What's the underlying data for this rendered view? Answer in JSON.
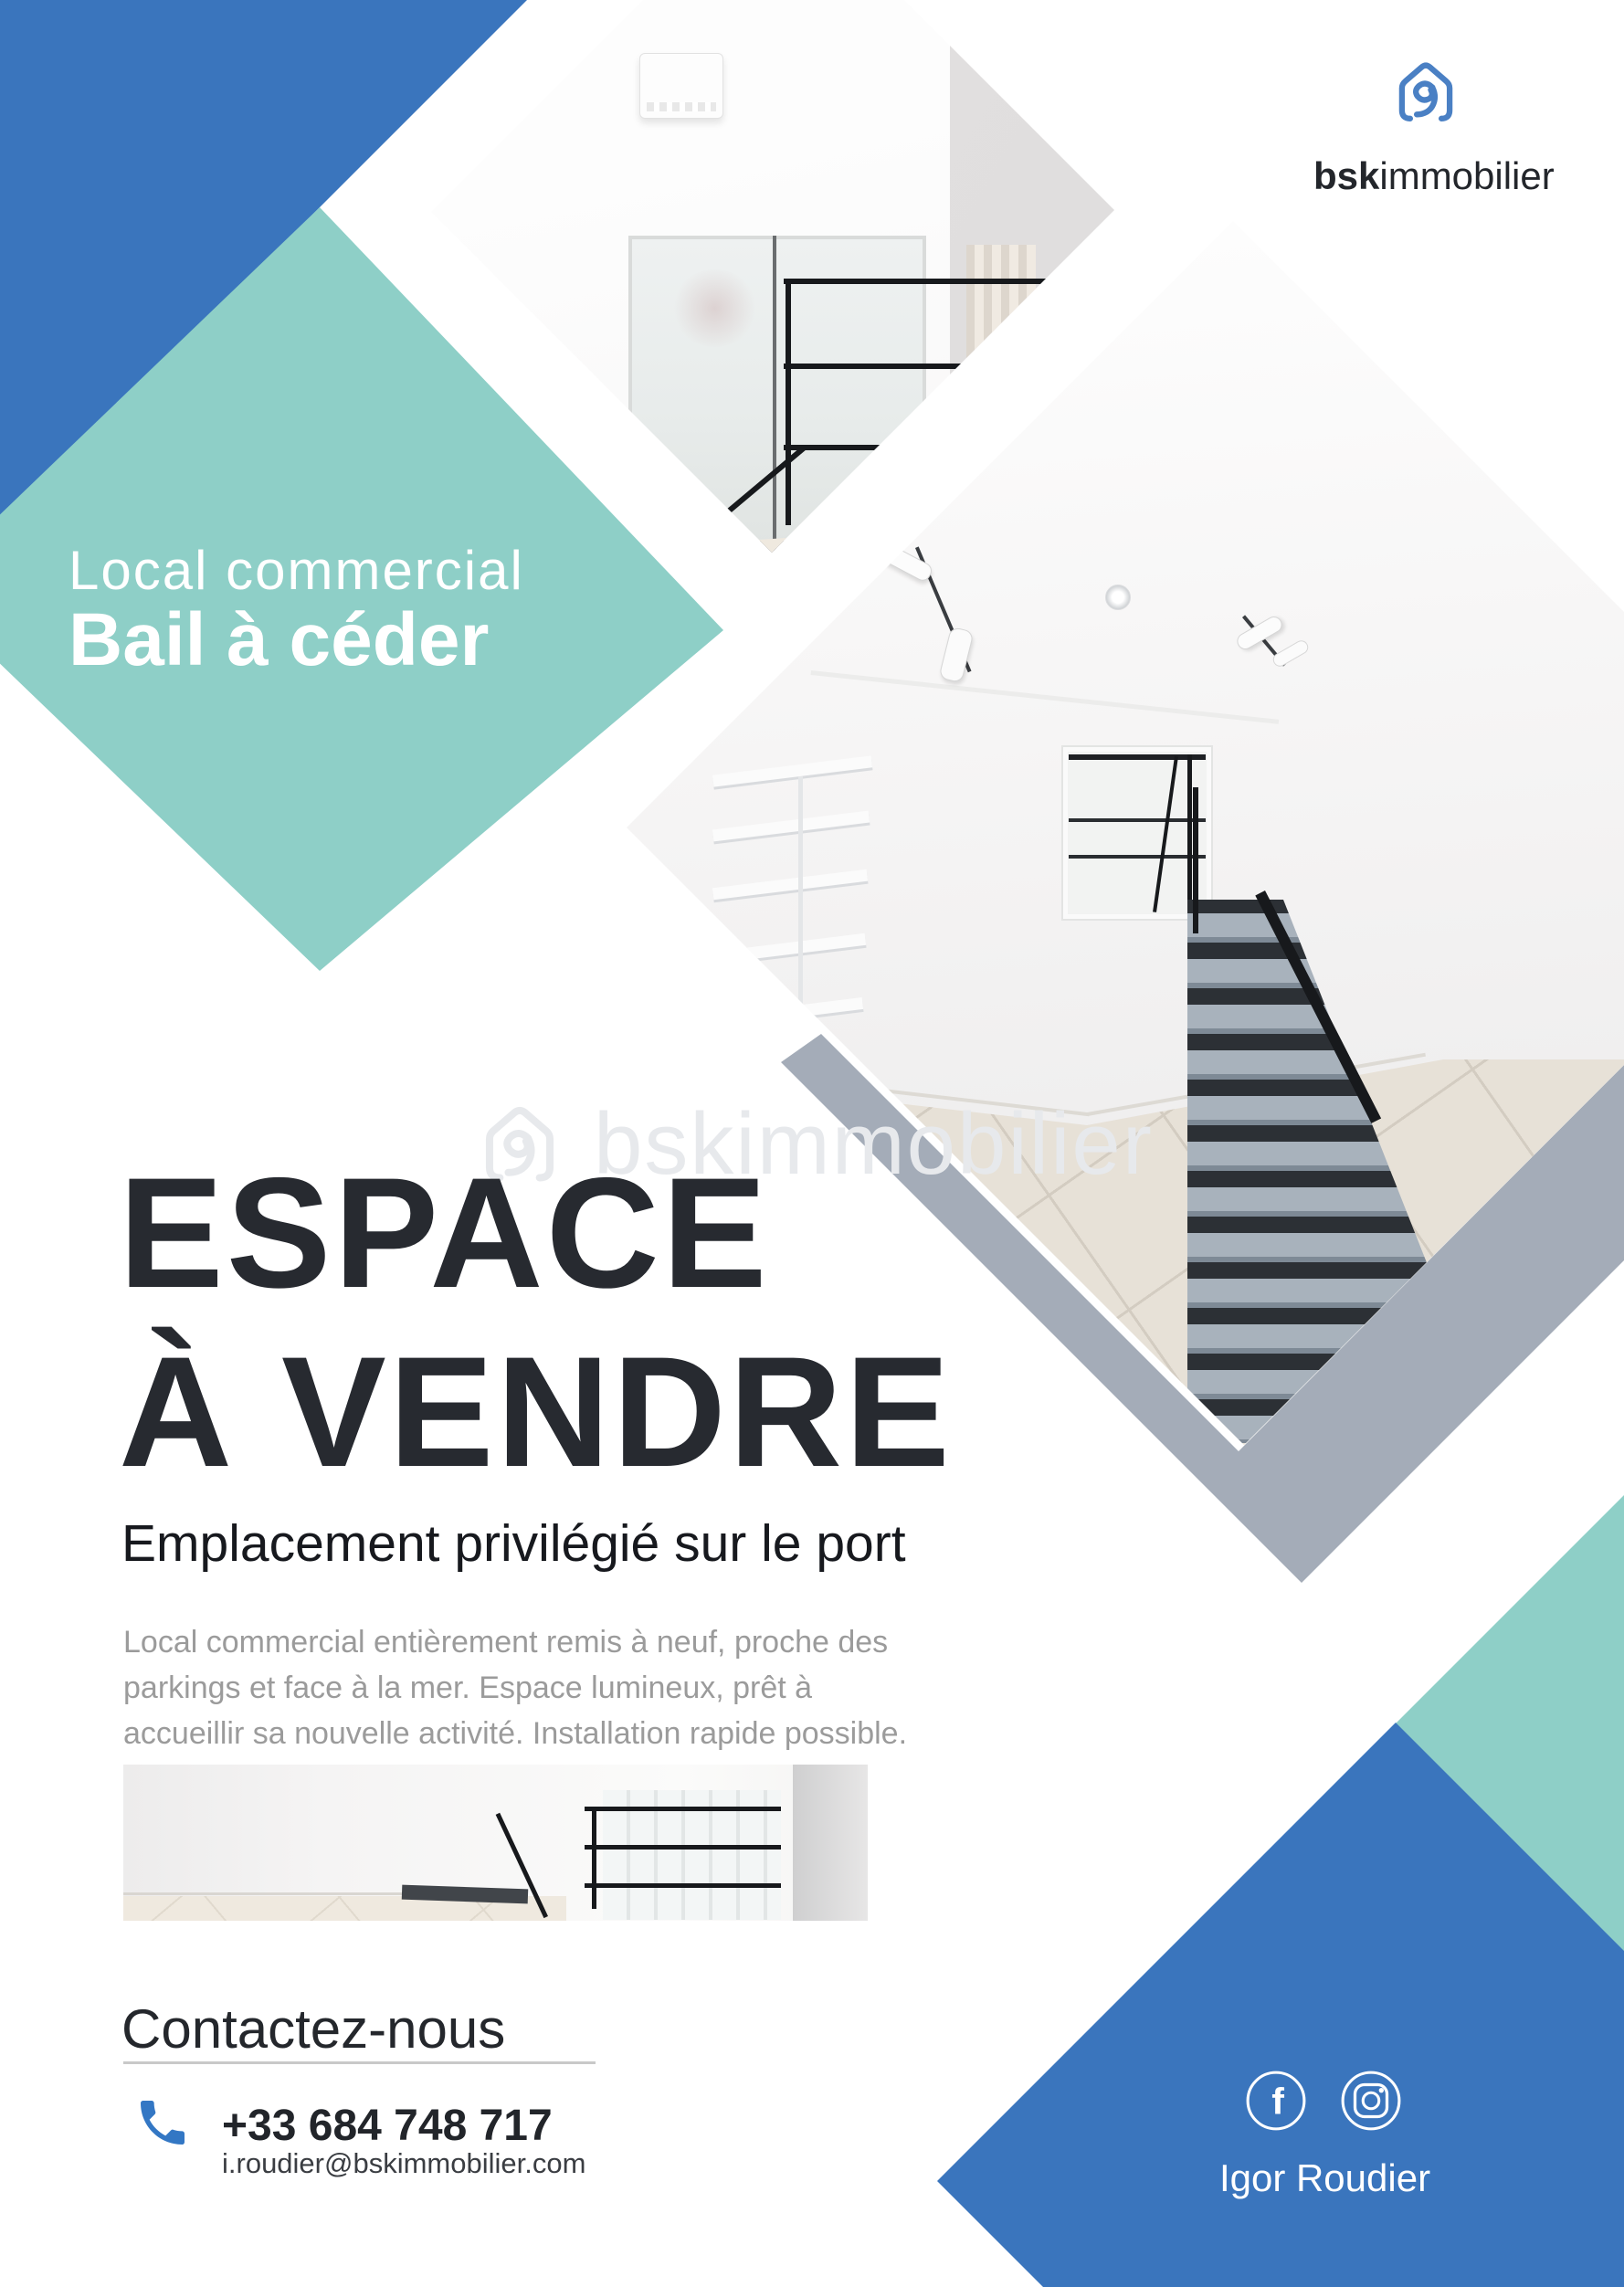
{
  "colors": {
    "blue": "#3a75bd",
    "teal": "#8ecfc7",
    "slate": "#a4acb8",
    "dark": "#26292e",
    "graytext": "#9b9b9b",
    "phoneblue": "#3377c4",
    "divider": "#c9c9c9",
    "wm": "#e7e9ec"
  },
  "brand": {
    "logo_bold": "bsk",
    "logo_regular": "immobilier"
  },
  "badge": {
    "line1": "Local commercial",
    "line2": "Bail à céder"
  },
  "watermark": {
    "text": "bskimmobilier"
  },
  "title": {
    "line1": "ESPACE",
    "line2": "À VENDRE"
  },
  "subtitle": "Emplacement privilégié sur le port",
  "description": {
    "line1": "Local commercial entièrement remis à neuf, proche des",
    "line2": "parkings et face à la mer. Espace lumineux, prêt à",
    "line3": "accueillir sa nouvelle activité. Installation rapide possible."
  },
  "contact": {
    "heading": "Contactez-nous",
    "phone": "+33 684 748 717",
    "email": "i.roudier@bskimmobilier.com"
  },
  "agent": {
    "name": "Igor Roudier"
  },
  "social": {
    "facebook_glyph": "f"
  }
}
